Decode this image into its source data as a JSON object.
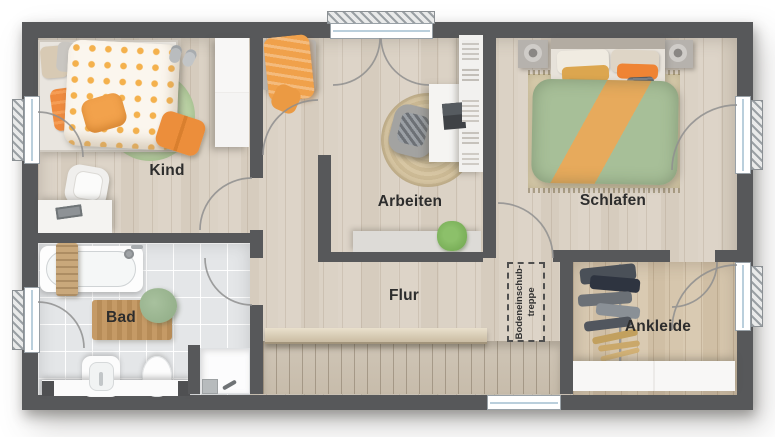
{
  "floorplan": {
    "title": "Obergeschoss Grundriss",
    "rooms": {
      "kind": "Kind",
      "arbeiten": "Arbeiten",
      "schlafen": "Schlafen",
      "bad": "Bad",
      "flur": "Flur",
      "ankleide": "Ankleide"
    },
    "annotations": {
      "attic_stairs_line1": "Bodeneinschub-",
      "attic_stairs_line2": "treppe"
    },
    "colors": {
      "wall": "#57585a",
      "wood_floor": "#d9d0c3",
      "warm_wood_floor": "#d5c6b0",
      "tile_floor": "#e4e6e8",
      "accent_orange": "#ee9a42",
      "duvet_green": "#a7bf98",
      "rug_green": "#b7cfa0",
      "rug_jute": "#d2c09c",
      "window_glass": "#bacfdc"
    }
  }
}
